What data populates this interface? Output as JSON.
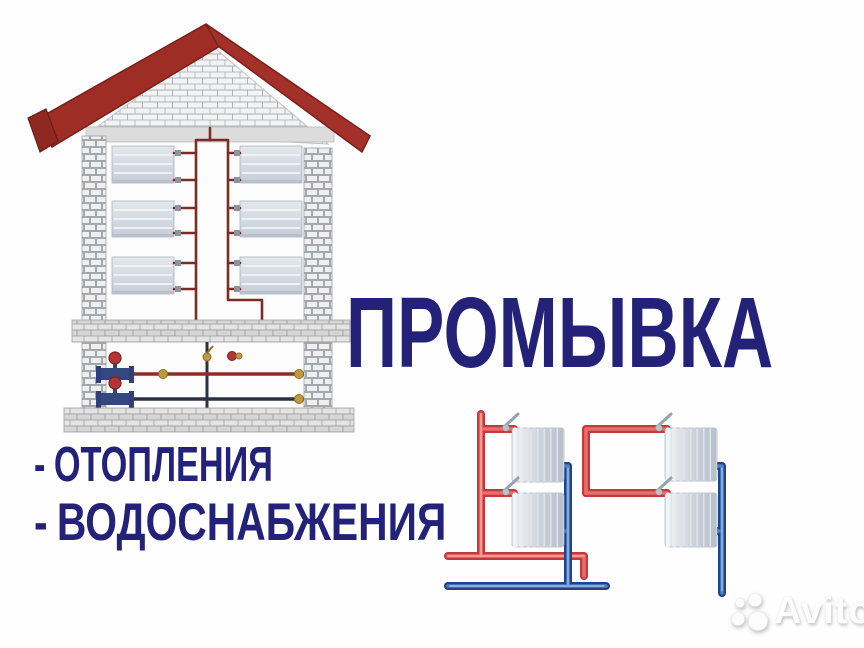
{
  "title": {
    "text": "ПРОМЫВКА",
    "color": "#232278"
  },
  "services": {
    "bullet": "-",
    "color": "#232278",
    "items": [
      {
        "label": "ОТОПЛЕНИЯ"
      },
      {
        "label": "ВОДОСНАБЖЕНИЯ"
      }
    ]
  },
  "watermark": {
    "logo_icon": "avito-circles-logo",
    "text": "Avito"
  },
  "illustrations": {
    "house": "brick house cutaway with three floors of radiators, red heating riser pipes and basement valves",
    "radiator_system": "two-pipe heating loop with four sectional radiators, red supply and blue return pipes"
  },
  "palette": {
    "headline_navy": "#232278",
    "roof_red": "#9d2d25",
    "house_pipe_maroon": "#7e2b24",
    "supply_pipe_red": "#d94545",
    "return_pipe_blue": "#1f4f9a",
    "radiator_gray": "#cfd6e0",
    "brick_mortar_gray": "#9aa0a6",
    "brass_valve": "#c09a3e",
    "valve_wheel_red": "#b53434",
    "valve_body_blue": "#35477f"
  }
}
